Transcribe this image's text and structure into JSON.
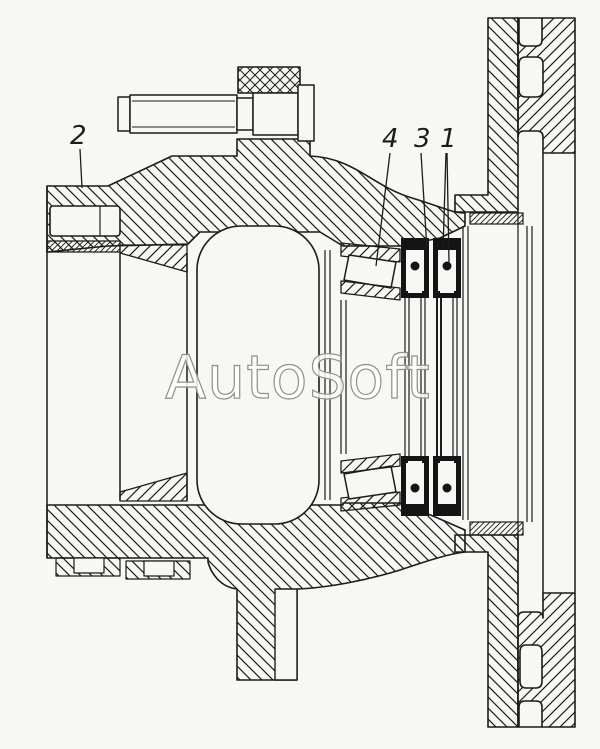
{
  "watermark": {
    "text": "AutoSoft"
  },
  "callouts": {
    "c2": {
      "label": "2"
    },
    "c4": {
      "label": "4"
    },
    "c3": {
      "label": "3"
    },
    "c1": {
      "label": "1"
    }
  },
  "colors": {
    "background": "#f7f7f4",
    "line": "#1c1c1c",
    "seal_fill": "#141414",
    "watermark_outline": "#8f8f8f"
  }
}
